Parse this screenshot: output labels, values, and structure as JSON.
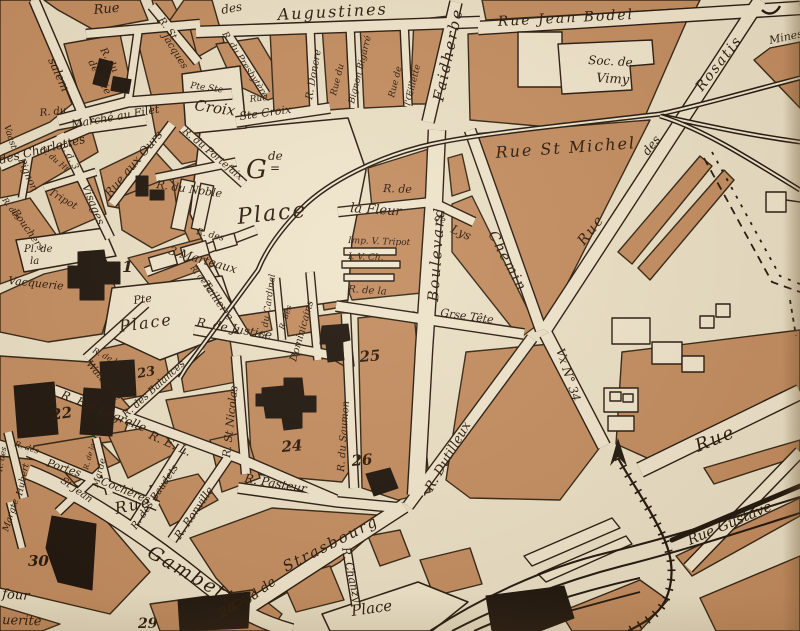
{
  "map": {
    "colors": {
      "paper": "#eae0c6",
      "street": "#efe5cc",
      "block": "#c28a5e",
      "ink": "#23150b",
      "monument": "#191009",
      "label_ink": "#241407"
    },
    "labels": {
      "rue_top": {
        "text": "Rue"
      },
      "salem": {
        "text": "salem"
      },
      "charlottes": {
        "text": "des Charlottes"
      },
      "stjacques1": {
        "text": "R. St"
      },
      "stjacques2": {
        "text": "Jacques"
      },
      "presbytere": {
        "text": "R. du Presbytère"
      },
      "flee1": {
        "text": "R. du"
      },
      "flee2": {
        "text": "de Flée"
      },
      "rdu_left": {
        "text": "R. du"
      },
      "marche_filet": {
        "text": "Marché au Filet"
      },
      "pte_ste": {
        "text": "Pte Ste"
      },
      "croix": {
        "text": "Croix"
      },
      "rue_sc": {
        "text": "Rue"
      },
      "ste_croix": {
        "text": "Ste Croix"
      },
      "des_aug": {
        "text": "des"
      },
      "augustines": {
        "text": "Augustines"
      },
      "jean_bodel": {
        "text": "Rue Jean Bodel"
      },
      "doncre": {
        "text": "R. Doncre"
      },
      "bignon1": {
        "text": "Rue du"
      },
      "bignon2": {
        "text": "Bignon Bigarré"
      },
      "oeillette1": {
        "text": "Rue de"
      },
      "oeillette2": {
        "text": "l'Œillette"
      },
      "faidherbe": {
        "text": "Faidherbe"
      },
      "vimy1": {
        "text": "Soc. de"
      },
      "vimy2": {
        "text": "Vimy"
      },
      "rosatis": {
        "text": "Rosatis"
      },
      "mines": {
        "text": "Mines"
      },
      "rosatis_des": {
        "text": "des"
      },
      "rosatis_rue": {
        "text": "Rue"
      },
      "st_michel": {
        "text": "Rue St Michel"
      },
      "chemin": {
        "text": "Chemin"
      },
      "gde_g": {
        "text": "G"
      },
      "gde_de": {
        "text": "de"
      },
      "gde_eq": {
        "text": "="
      },
      "gde_place": {
        "text": "Place"
      },
      "fleur1": {
        "text": "R. de"
      },
      "fleur2": {
        "text": "la Fleur"
      },
      "fleur3": {
        "text": "de"
      },
      "fleur4": {
        "text": "Lys"
      },
      "imp_tripot": {
        "text": "Imp. V. Tripot"
      },
      "ivch": {
        "text": "I. V. Ch."
      },
      "boulevard": {
        "text": "Boulevard"
      },
      "grosse1": {
        "text": "R. de la"
      },
      "grosse2": {
        "text": "Grse Tête"
      },
      "vx34": {
        "text": "Vx N° 34"
      },
      "rue_right": {
        "text": "Rue"
      },
      "rue_gustave": {
        "text": "Rue Gustave"
      },
      "dutilleux": {
        "text": "R. Dutilleux"
      },
      "chanzy": {
        "text": "R. Chanzy"
      },
      "place_b": {
        "text": "Place"
      },
      "n28": {
        "text": "28"
      },
      "bd_de": {
        "text": "Bd de"
      },
      "strasbourg": {
        "text": "Strasbourg"
      },
      "pasteur": {
        "text": "R. Pasteur"
      },
      "saumon": {
        "text": "R. du Saumon"
      },
      "n26": {
        "text": "26"
      },
      "n24": {
        "text": "24"
      },
      "n25": {
        "text": "25"
      },
      "n23": {
        "text": "23"
      },
      "n22": {
        "text": "22"
      },
      "n1": {
        "text": "1"
      },
      "n30": {
        "text": "30"
      },
      "n29": {
        "text": "29"
      },
      "pte1": {
        "text": "Pte"
      },
      "pte2": {
        "text": "Place"
      },
      "vacq1": {
        "text": "Pl. de"
      },
      "vacq2": {
        "text": "la"
      },
      "vacq3": {
        "text": "Vacquerie"
      },
      "bouchers1": {
        "text": "R. des"
      },
      "bouchers2": {
        "text": "Bouchers"
      },
      "vaast": {
        "text": "Vaast"
      },
      "pignon1": {
        "text": "R. du Ht"
      },
      "pignon2": {
        "text": "Pignon"
      },
      "tripot_st": {
        "text": "Tripot"
      },
      "visages1": {
        "text": "R. d. 3"
      },
      "visages2": {
        "text": "Visages"
      },
      "ours": {
        "text": "Rue aux Ours"
      },
      "portefaix": {
        "text": "R. du Portefaix"
      },
      "noble": {
        "text": "R. du Noble"
      },
      "marteaux1": {
        "text": "R. des"
      },
      "marteaux2": {
        "text": "3 Marteaux"
      },
      "taillerie1": {
        "text": "R. de la"
      },
      "taillerie2": {
        "text": "Taillerie"
      },
      "justice": {
        "text": "R. de Justice"
      },
      "cardinal": {
        "text": "R. du Cardinal"
      },
      "dominicains1": {
        "text": "R. des"
      },
      "dominicains2": {
        "text": "Dominicains"
      },
      "st_nicolas": {
        "text": "R. St Nicolas"
      },
      "watelette1": {
        "text": "R. de la"
      },
      "watelette2": {
        "text": "Watelette"
      },
      "balances": {
        "text": "R. des Balances"
      },
      "legrelle": {
        "text": "R. Em Legrelle"
      },
      "rel": {
        "text": "R. E. L."
      },
      "baudets": {
        "text": "R. des Baudets"
      },
      "ronville": {
        "text": "R. Ronville"
      },
      "portes": {
        "text": "Portes"
      },
      "cocheres": {
        "text": "Cochères"
      },
      "rdes_pc": {
        "text": "R. des"
      },
      "st_jean": {
        "text": "St Jean"
      },
      "marde1": {
        "text": "R. de la"
      },
      "marde2": {
        "text": "Marde"
      },
      "gerard": {
        "text": "R. des"
      },
      "hubert": {
        "text": "Hubert"
      },
      "margte": {
        "text": "Margte"
      },
      "rue_gamb": {
        "text": "Rue"
      },
      "gambetta": {
        "text": "Gambetta"
      },
      "four": {
        "text": "four"
      },
      "uerite": {
        "text": "uerite"
      }
    }
  }
}
